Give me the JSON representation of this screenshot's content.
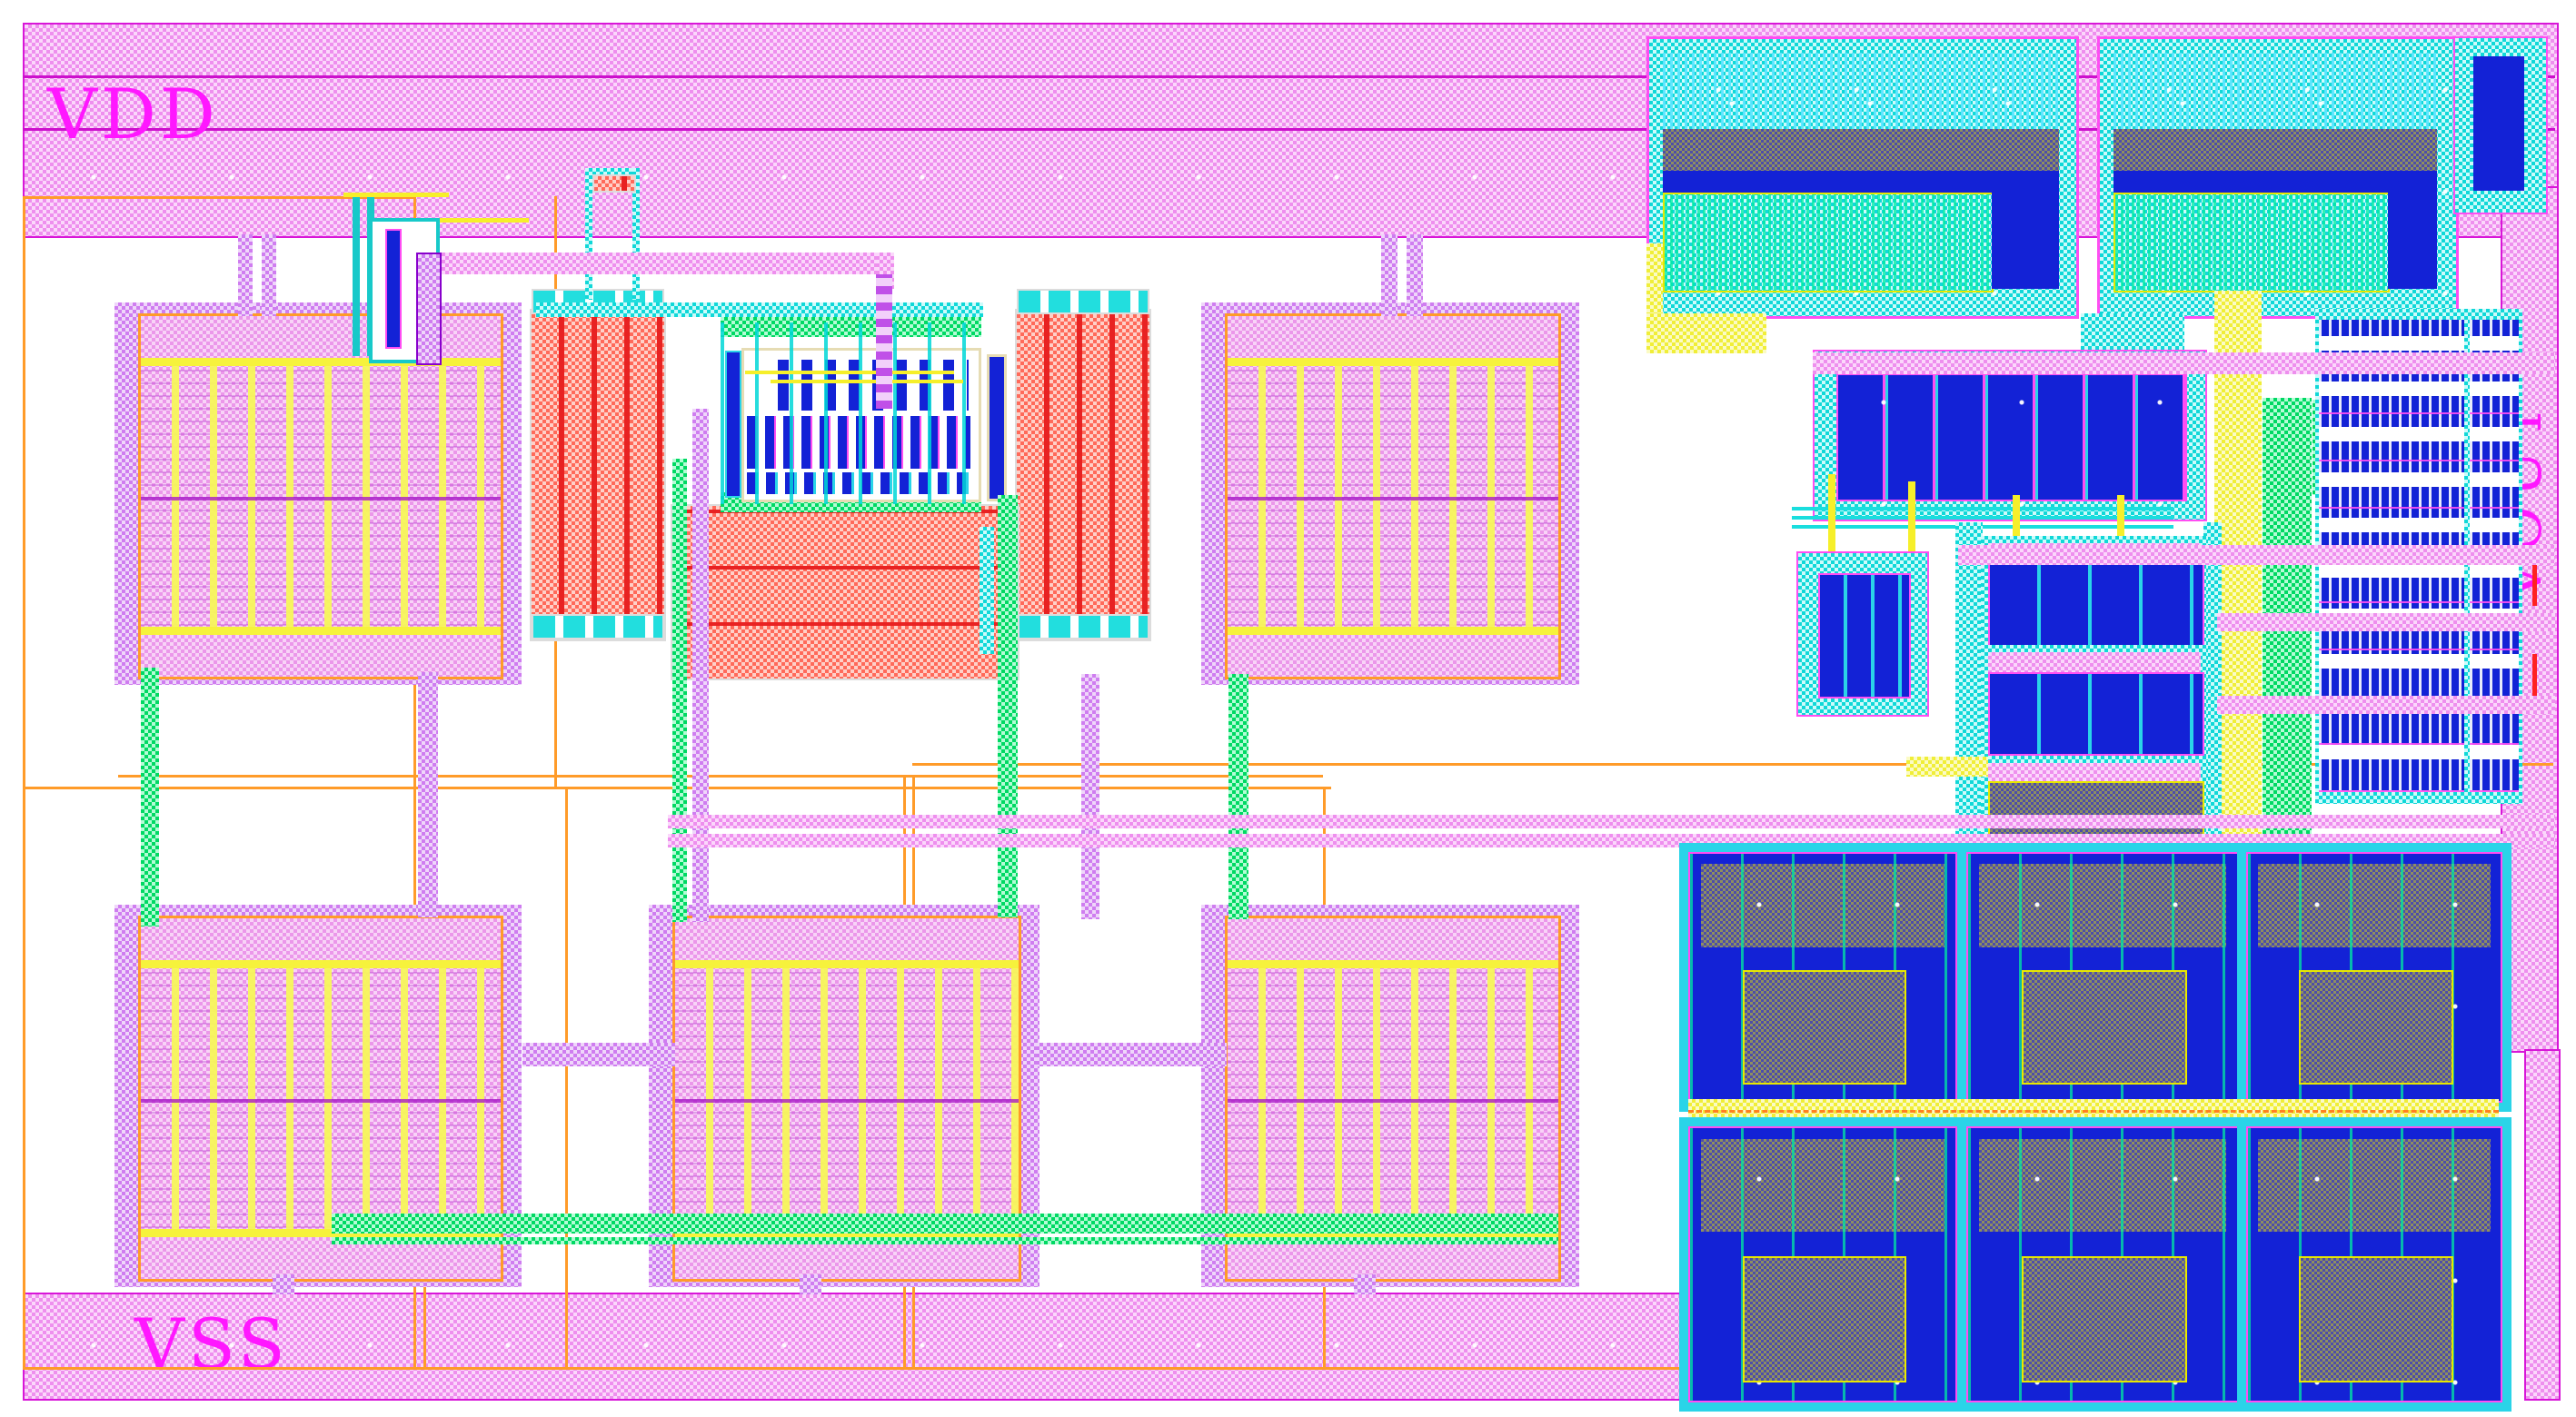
{
  "title": "IC Layout",
  "labels": {
    "vdd": "VDD",
    "vss": "VSS",
    "vout": "VOUT"
  },
  "layers": [
    {
      "name": "metal-pink",
      "color": "#ee8fee"
    },
    {
      "name": "metal-violet",
      "color": "#cf7df0"
    },
    {
      "name": "metal-cyan",
      "color": "#10d8d8"
    },
    {
      "name": "metal-green",
      "color": "#00d963"
    },
    {
      "name": "metal-yellow",
      "color": "#f0ee38"
    },
    {
      "name": "poly-resistor-red",
      "color": "#ff6a5a"
    },
    {
      "name": "diffusion-blue",
      "color": "#1322d6"
    },
    {
      "name": "well-orange",
      "color": "#ff9b29"
    },
    {
      "name": "cap-overlap-gray",
      "color": "#8f8f60"
    },
    {
      "name": "dark-blue-hatch",
      "color": "#2a2ace"
    },
    {
      "name": "marker-red",
      "color": "#ff2222"
    },
    {
      "name": "label-magenta",
      "color": "#ff17ff"
    }
  ]
}
